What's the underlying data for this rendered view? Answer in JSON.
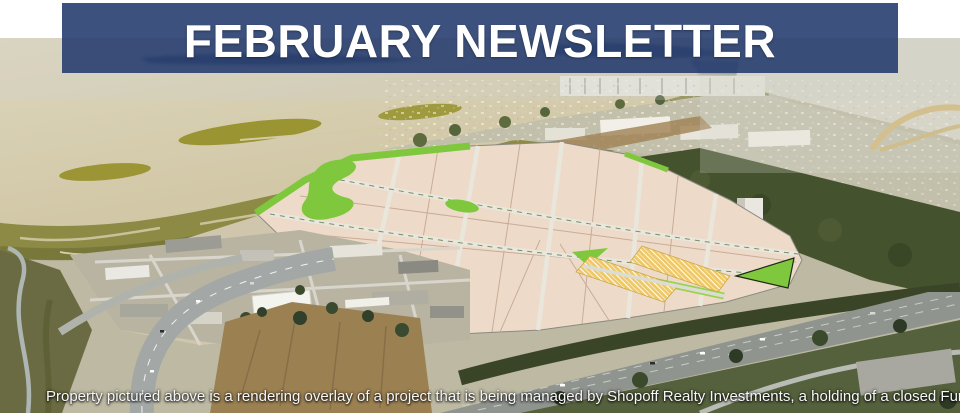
{
  "banner": {
    "title": "FEBRUARY NEWSLETTER",
    "colors": {
      "background": "#283E70",
      "text": "#FFFFFF"
    }
  },
  "caption": {
    "text": "Property pictured above is a rendering overlay of a project that is being managed by Shopoff Realty Investments, a holding of a closed Fund."
  },
  "photo": {
    "description": "Aerial photograph of a bayside property with a site-plan rendering overlay: pale pink development parcels divided by light roads, bright green landscaping strips, and yellow cross-hatched parcels; surrounded by tan bay water and marshland on the left, hazy suburbs and industrial buildings on the right, and tree-lined freeways at the bottom.",
    "colors": {
      "bay_water": "#D5CDAE",
      "marsh": "#8D8A44",
      "parcel_fill": "#EEDAC9",
      "landscaping_green": "#7FC83E",
      "hatched_parcel_yellow": "#F0C967",
      "road_gray": "#9AA09E",
      "tree_dark_green": "#42512F",
      "haze": "#CCD2D8"
    }
  }
}
